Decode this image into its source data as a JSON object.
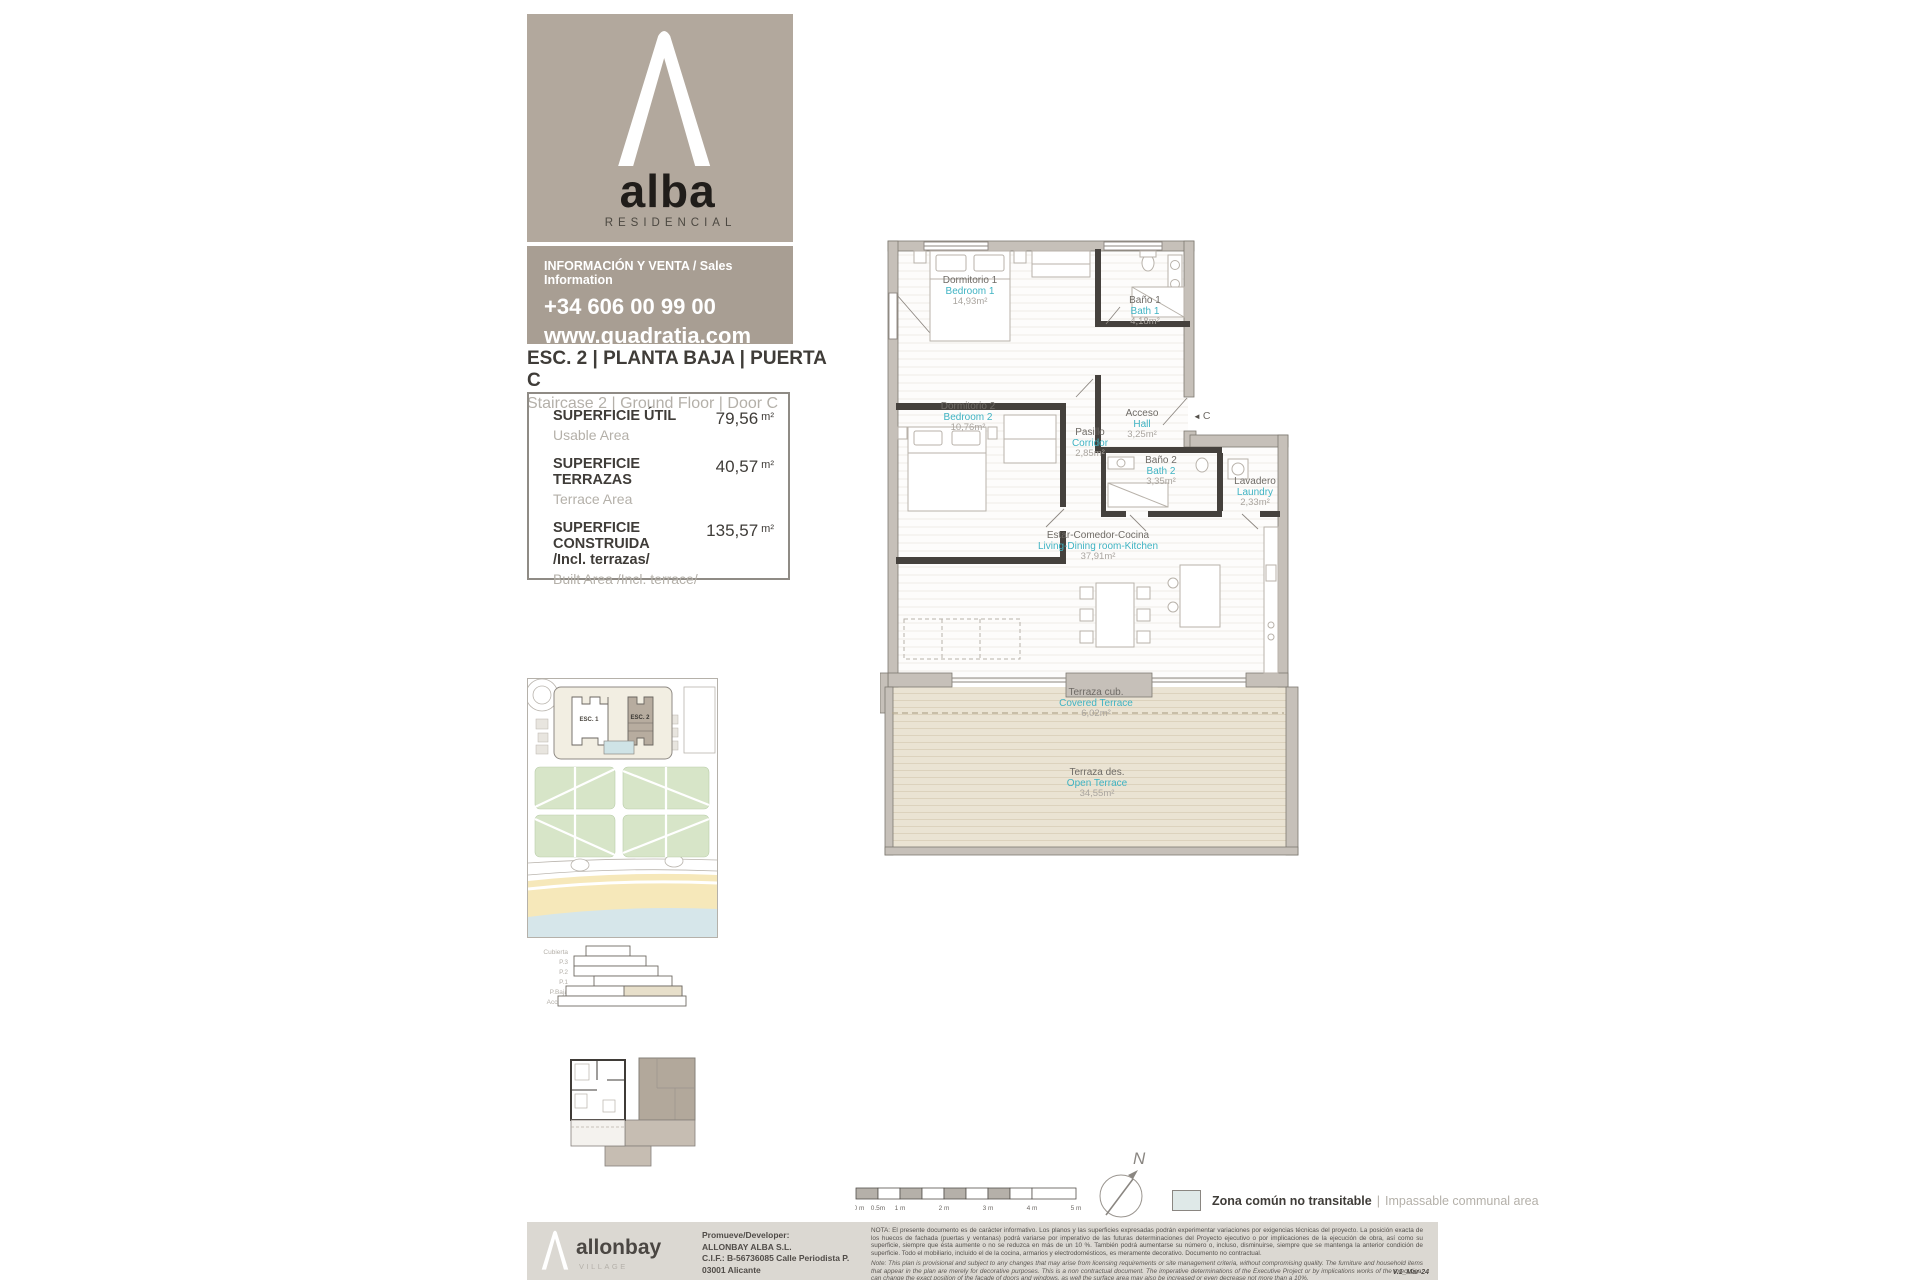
{
  "brand": {
    "name": "alba",
    "tagline": "RESIDENCIAL",
    "info_label": "INFORMACIÓN Y VENTA / Sales Information",
    "phone": "+34 606 00 99 00",
    "website": "www.quadratia.com"
  },
  "unit": {
    "title_es": "ESC. 2 | PLANTA BAJA | PUERTA C",
    "title_en": "Staircase 2 | Ground Floor | Door C",
    "areas": [
      {
        "label_es": "SUPERFICIE ÚTIL",
        "label_es2": "",
        "label_en": "Usable Area",
        "value": "79,56",
        "unit": "m²"
      },
      {
        "label_es": "SUPERFICIE TERRAZAS",
        "label_es2": "",
        "label_en": "Terrace Area",
        "value": "40,57",
        "unit": "m²"
      },
      {
        "label_es": "SUPERFICIE CONSTRUIDA",
        "label_es2": "/Incl. terrazas/",
        "label_en": "Built Area /Incl. terrace/",
        "value": "135,57",
        "unit": "m²"
      }
    ]
  },
  "plan": {
    "rooms": [
      {
        "name_es": "Dormitorio 1",
        "name_en": "Bedroom 1",
        "area": "14,93m²"
      },
      {
        "name_es": "Baño 1",
        "name_en": "Bath 1",
        "area": "4,18m²"
      },
      {
        "name_es": "Dormitorio 2",
        "name_en": "Bedroom 2",
        "area": "10,76m²"
      },
      {
        "name_es": "Pasillo",
        "name_en": "Corridor",
        "area": "2,85m²"
      },
      {
        "name_es": "Acceso",
        "name_en": "Hall",
        "area": "3,25m²"
      },
      {
        "name_es": "Baño 2",
        "name_en": "Bath 2",
        "area": "3,35m²"
      },
      {
        "name_es": "Lavadero",
        "name_en": "Laundry",
        "area": "2,33m²"
      },
      {
        "name_es": "Estar-Comedor-Cocina",
        "name_en": "Living-Dining room-Kitchen",
        "area": "37,91m²"
      },
      {
        "name_es": "Terraza cub.",
        "name_en": "Covered Terrace",
        "area": "6,02m²"
      },
      {
        "name_es": "Terraza des.",
        "name_en": "Open Terrace",
        "area": "34,55m²"
      }
    ],
    "entrance_label": "C"
  },
  "icons": {
    "entrance_arrow": "◄"
  },
  "site_plan": {
    "building_1": "ESC. 1",
    "building_2": "ESC. 2"
  },
  "section": {
    "levels": [
      "Cubierta",
      "P.3",
      "P.2",
      "P.1",
      "P.Baja",
      "Acceso"
    ]
  },
  "compass": {
    "north": "N"
  },
  "scale_bar": {
    "labels": [
      "0 m",
      "0.5m",
      "1 m",
      "2 m",
      "3 m",
      "4 m",
      "5 m"
    ]
  },
  "legend": {
    "separator": "|",
    "label_es": "Zona común no transitable",
    "label_en": "Impassable communal area",
    "swatch_color": "#dfe9e8"
  },
  "footer": {
    "logo_name": "allonbay",
    "logo_sub": "VILLAGE",
    "developer_label": "Promueve/Developer:",
    "developer_name": "ALLONBAY ALBA S.L.",
    "developer_cif": "C.I.F.: B-56736085 Calle Periodista P.",
    "developer_city": "03001 Alicante",
    "note_es": "NOTA:  El presente documento es de carácter informativo. Los planos y las superficies expresadas podrán experimentar variaciones por exigencias técnicas del proyecto. La posición exacta de los huecos de fachada (puertas y ventanas) podrá variarse por imperativo de las futuras determinaciones del Proyecto ejecutivo o por implicaciones de la ejecución de obra, así como su superficie, siempre que ésta aumente o no se reduzca en más de un 10 %. También podrá aumentarse su número o, incluso, disminuirse, siempre que se mantenga la anterior condición de superficie. Todo el mobiliario, incluido el de la cocina, armarios y electrodomésticos, es meramente decorativo. Documento no contractual.",
    "note_en": "Note: This plan is provisional and subject to any changes that may arise from licensing requirements or site management criteria, without compromising quality. The furniture and household items that appear in the plan are merely for decorative purposes. This is a non contractual document. The imperative determinations of the Executive Project or by implications works of the execution, can change the exact position of the facade of doors and windows, as well the surface area may also be increased or even decrease not more than a 10%.",
    "version": "V.1_Mar-24"
  },
  "colors": {
    "accent_teal": "#3fb3c3",
    "brand_taupe": "#b2a89d",
    "brand_taupe_dark": "#a89e93",
    "wall_gray": "#c6c0b9",
    "terrace_beige": "#eae3d3",
    "footer_gray": "#dbd8d2",
    "legend_swatch": "#dfe9e8"
  }
}
